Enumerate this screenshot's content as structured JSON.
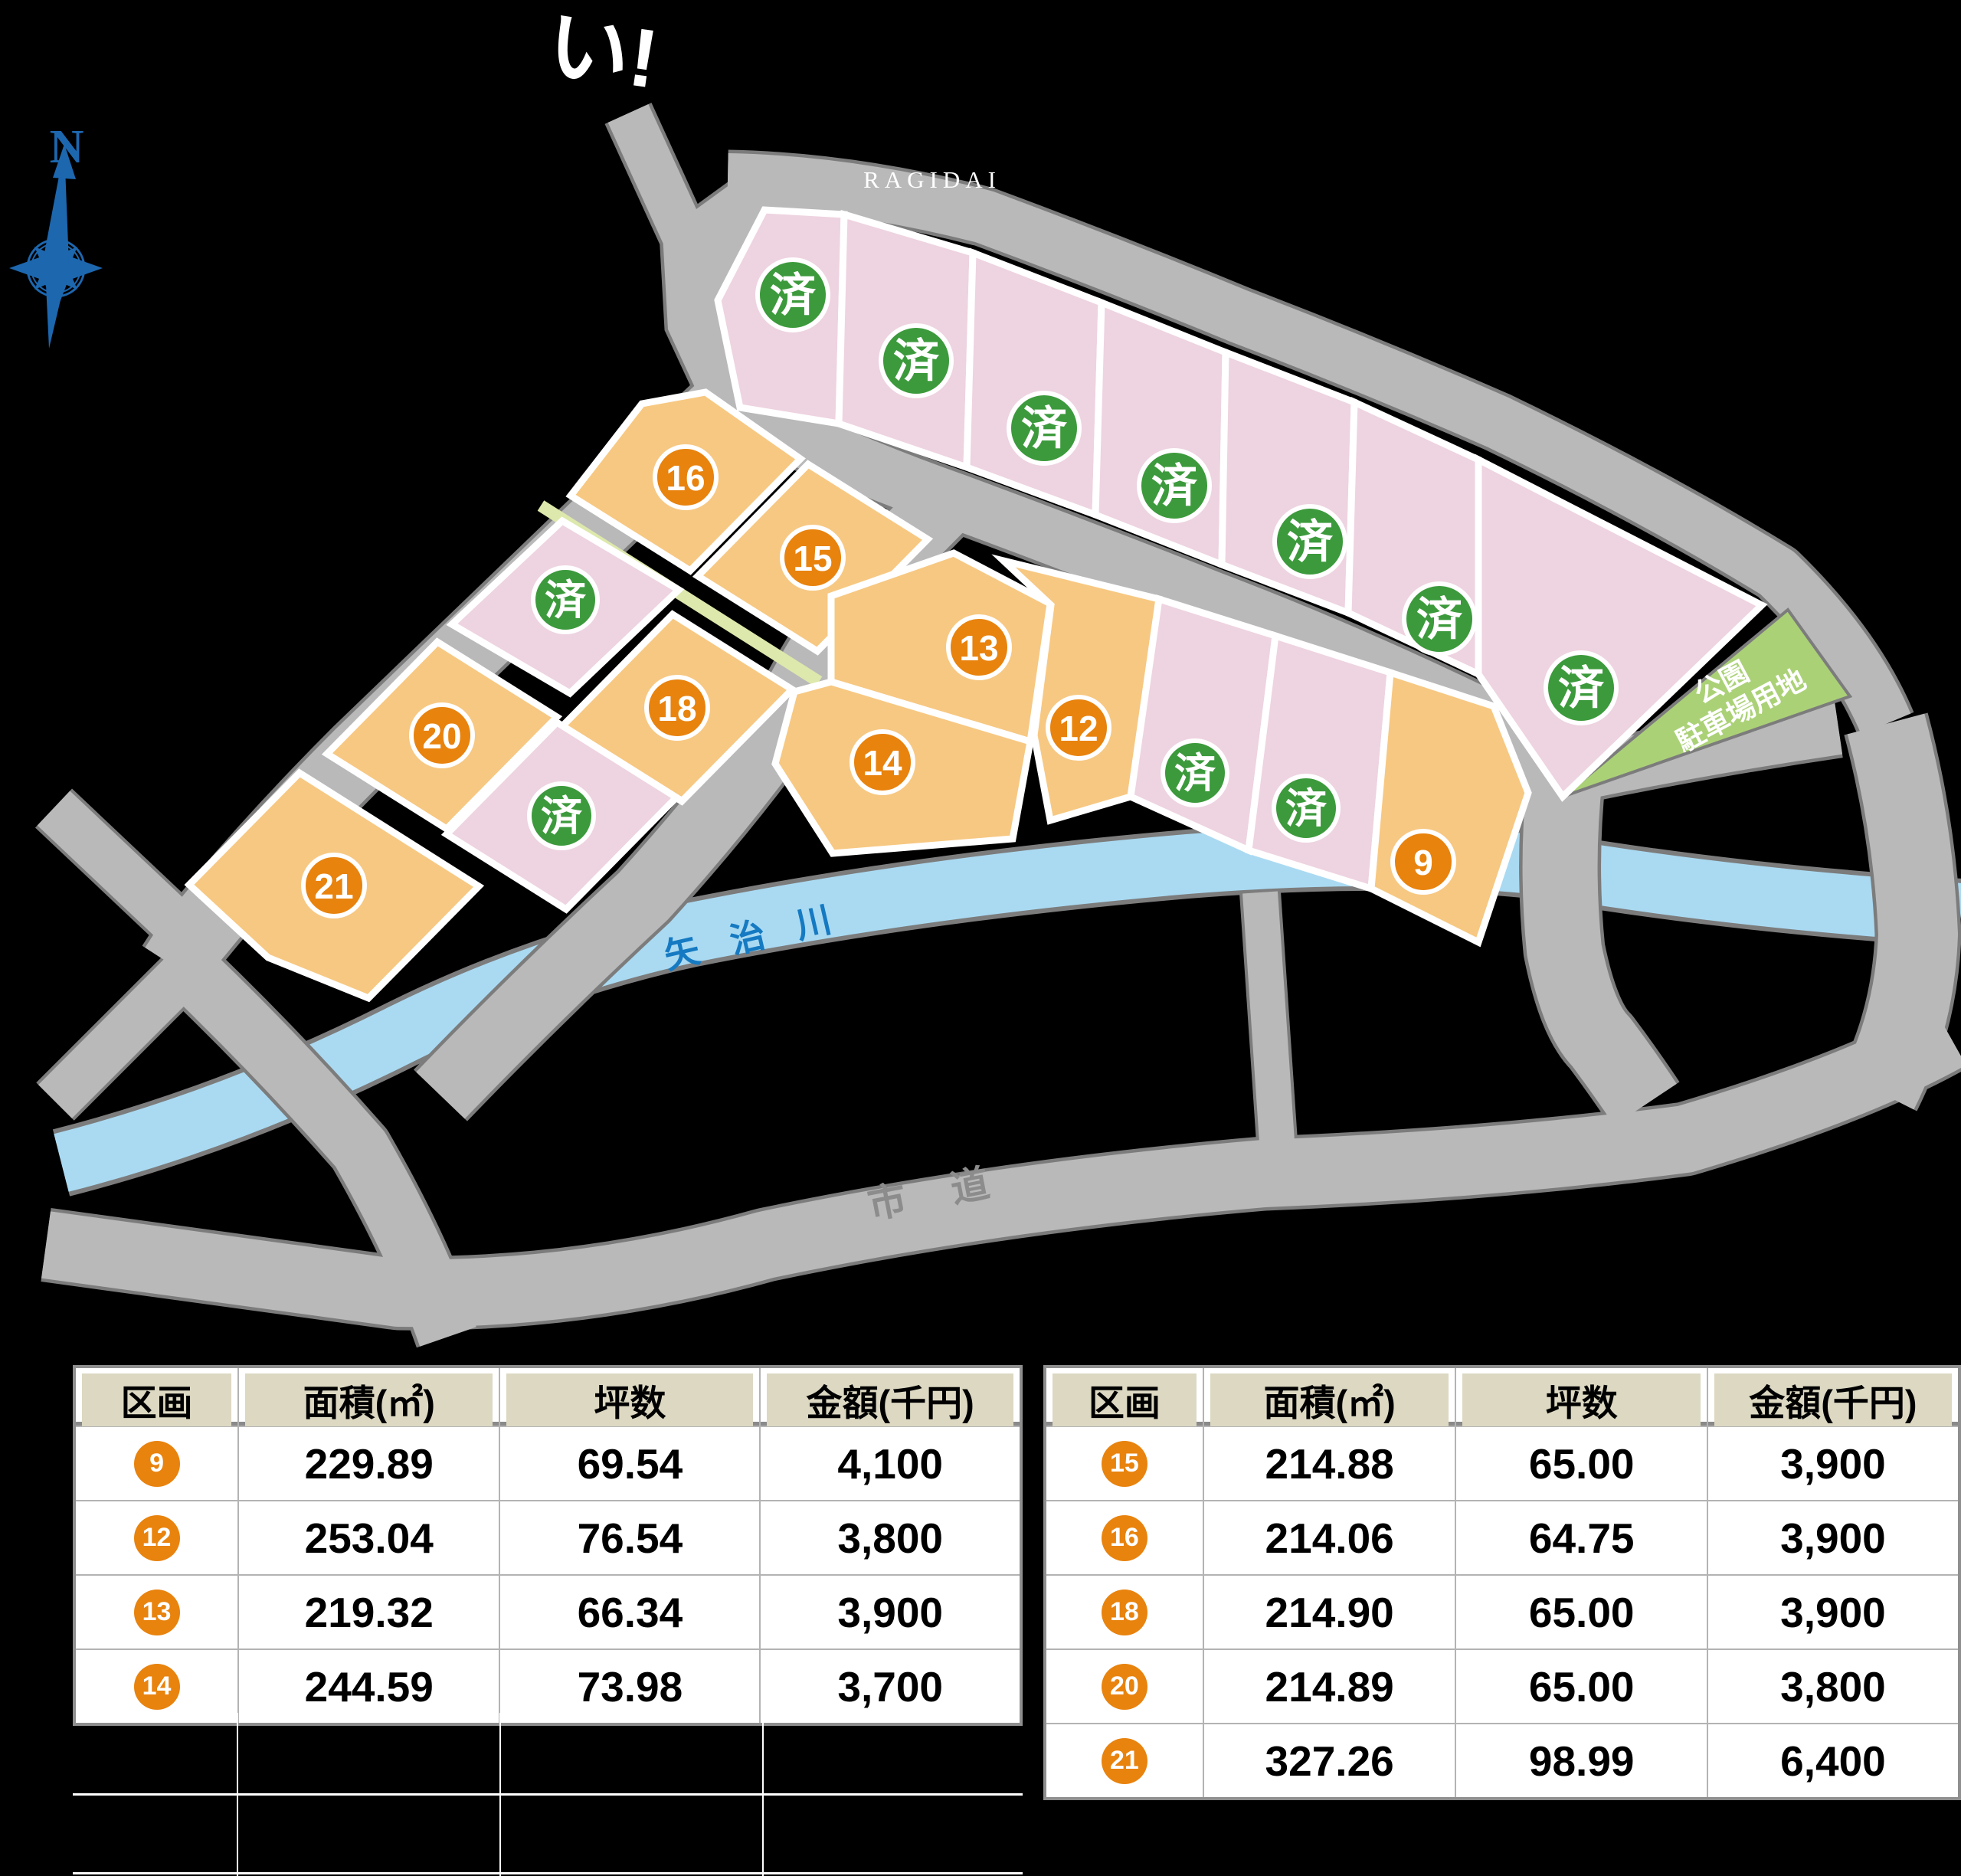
{
  "map": {
    "title_fragment": "い!",
    "area_label": "RAGIDAI",
    "compass_label": "N",
    "river_label": "矢治川",
    "city_road_label": "市道",
    "park_label_line1": "公園",
    "park_label_line2": "駐車場用地",
    "sold_label": "済",
    "colors": {
      "road": "#b9b9b9",
      "road_edge": "#7c7c7c",
      "river": "#aadaf2",
      "lot_available": "#f7c882",
      "lot_sold": "#eed3e0",
      "badge_sold": "#3c9a3c",
      "badge_number": "#e8830e",
      "park": "#abd177",
      "path_strip": "#dde8ac",
      "compass_blue": "#1d67af",
      "river_text": "#157ac2",
      "road_text": "#8c8c8c"
    },
    "lots": [
      {
        "label": "済",
        "status": "sold",
        "group": "top-row"
      },
      {
        "label": "済",
        "status": "sold",
        "group": "top-row"
      },
      {
        "label": "済",
        "status": "sold",
        "group": "top-row"
      },
      {
        "label": "済",
        "status": "sold",
        "group": "top-row"
      },
      {
        "label": "済",
        "status": "sold",
        "group": "top-row"
      },
      {
        "label": "済",
        "status": "sold",
        "group": "top-row"
      },
      {
        "label": "済",
        "status": "sold",
        "group": "top-row"
      },
      {
        "label": "16",
        "status": "available",
        "group": "west-cluster"
      },
      {
        "label": "15",
        "status": "available",
        "group": "west-cluster"
      },
      {
        "label": "済",
        "status": "sold",
        "group": "west-cluster"
      },
      {
        "label": "18",
        "status": "available",
        "group": "west-cluster"
      },
      {
        "label": "20",
        "status": "available",
        "group": "west-cluster"
      },
      {
        "label": "済",
        "status": "sold",
        "group": "west-cluster"
      },
      {
        "label": "21",
        "status": "available",
        "group": "west-cluster"
      },
      {
        "label": "13",
        "status": "available",
        "group": "center-cluster"
      },
      {
        "label": "12",
        "status": "available",
        "group": "center-cluster"
      },
      {
        "label": "14",
        "status": "available",
        "group": "center-cluster"
      },
      {
        "label": "済",
        "status": "sold",
        "group": "center-cluster"
      },
      {
        "label": "済",
        "status": "sold",
        "group": "center-cluster"
      },
      {
        "label": "9",
        "status": "available",
        "group": "center-cluster"
      }
    ]
  },
  "tables": {
    "headers": [
      "区画",
      "面積(㎡)",
      "坪数",
      "金額(千円)"
    ],
    "left": {
      "rows": [
        [
          "9",
          "229.89",
          "69.54",
          "4,100"
        ],
        [
          "12",
          "253.04",
          "76.54",
          "3,800"
        ],
        [
          "13",
          "219.32",
          "66.34",
          "3,900"
        ],
        [
          "14",
          "244.59",
          "73.98",
          "3,700"
        ]
      ]
    },
    "right": {
      "rows": [
        [
          "15",
          "214.88",
          "65.00",
          "3,900"
        ],
        [
          "16",
          "214.06",
          "64.75",
          "3,900"
        ],
        [
          "18",
          "214.90",
          "65.00",
          "3,900"
        ],
        [
          "20",
          "214.89",
          "65.00",
          "3,800"
        ],
        [
          "21",
          "327.26",
          "98.99",
          "6,400"
        ]
      ]
    }
  }
}
